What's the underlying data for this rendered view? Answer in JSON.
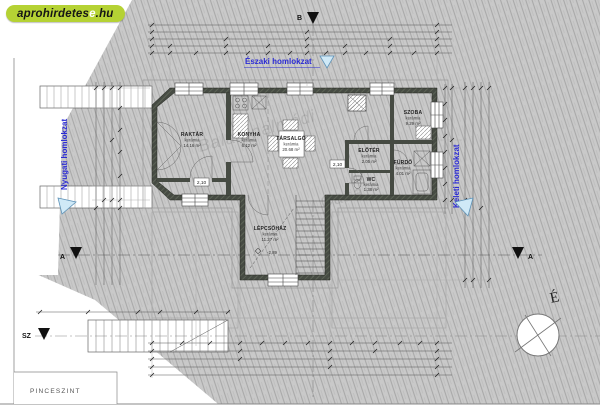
{
  "logo": {
    "main": "aprohirdetes",
    "accent": "e",
    "suffix": ".hu"
  },
  "floor_title": "PINCESZINT",
  "facades": {
    "north": "Északi homlokzat",
    "west": "Nyugati homlokzat",
    "east": "Keleti homlokzat"
  },
  "markers": {
    "section_a": "A",
    "section_b": "B",
    "section_sz": "SZ",
    "north_compass": "É",
    "level": "-2,89",
    "door_height": "2,10"
  },
  "rooms": [
    {
      "name": "RAKTÁR",
      "finish": "kerámia",
      "area": "14.16 m²"
    },
    {
      "name": "KONYHA",
      "finish": "kerámia",
      "area": "6.12 m²"
    },
    {
      "name": "TÁRSALGÓ",
      "finish": "kerámia",
      "area": "20.68 m²"
    },
    {
      "name": "SZOBA",
      "finish": "kerámia",
      "area": "9.29 m²"
    },
    {
      "name": "ELŐTÉR",
      "finish": "kerámia",
      "area": "2.05 m²"
    },
    {
      "name": "FÜRDŐ",
      "finish": "kerámia",
      "area": "4.01 m²"
    },
    {
      "name": "WC",
      "finish": "kerámia",
      "area": "1.38 m²"
    },
    {
      "name": "LÉPCSŐHÁZ",
      "finish": "kerámia",
      "area": "11.27 m²"
    }
  ],
  "watermarks": {
    "w1": "Balatonalmádi",
    "w2": "Casa"
  },
  "colors": {
    "logo_green": "#b5d234",
    "facade_blue": "#2b2bd5",
    "triangle_fill": "#cfe9f7",
    "wall_dark": "#464b43",
    "site_gray": "#c9c9c9"
  }
}
